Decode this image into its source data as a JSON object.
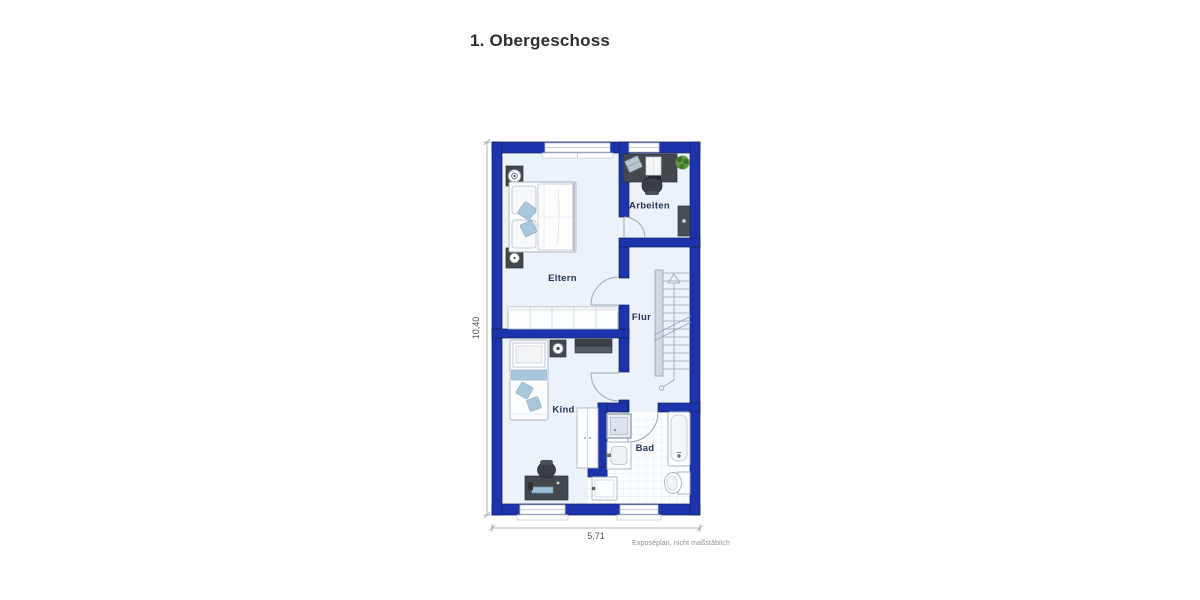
{
  "title": "1. Obergeschoss",
  "footer_note": "Exposéplan, nicht maßstäblich",
  "floorplan": {
    "dimensions": {
      "height_label": "10,40",
      "width_label": "5,71"
    },
    "rooms": [
      {
        "id": "eltern",
        "label": "Eltern"
      },
      {
        "id": "arbeiten",
        "label": "Arbeiten"
      },
      {
        "id": "flur",
        "label": "Flur"
      },
      {
        "id": "kind",
        "label": "Kind"
      },
      {
        "id": "bad",
        "label": "Bad"
      }
    ],
    "colors": {
      "wall": "#1d33ab",
      "wall_outline": "#11215f",
      "floor": "#ecf2f9",
      "tile_floor": "#fbfdfe",
      "accent_textile": "#a9c6da",
      "furniture_dark": "#43484f",
      "plan_line": "#9ba7b5",
      "label_text": "#24335a"
    }
  }
}
